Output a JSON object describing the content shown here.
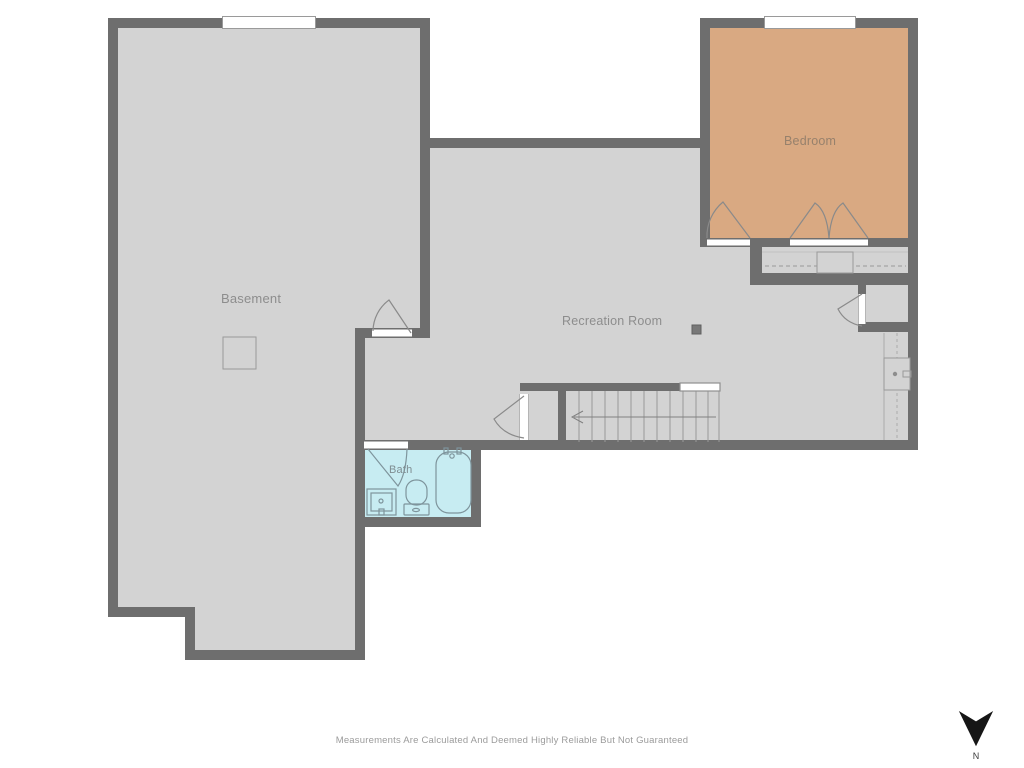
{
  "rooms": {
    "basement": {
      "label": "Basement"
    },
    "recreation": {
      "label": "Recreation Room"
    },
    "bedroom": {
      "label": "Bedroom"
    },
    "bath": {
      "label": "Bath"
    }
  },
  "footer": {
    "disclaimer": "Measurements Are Calculated And Deemed Highly Reliable But Not Guaranteed"
  },
  "compass": {
    "label": "N",
    "direction": "north-points-down"
  },
  "features": {
    "stairs": "staircase-with-down-direction-arrow",
    "closet": "closet-with-hanging-rod-and-shelf",
    "utility": "water-heater-utility-area",
    "bath_fixtures": [
      "sink-vanity",
      "toilet",
      "bathtub"
    ]
  },
  "colors": {
    "wall": "#6e6e6e",
    "floor": "#d3d3d3",
    "bedroom_floor": "#d9a982",
    "bath_floor": "#c7ecf2",
    "door_line": "#8a8a8a",
    "fixture_line": "#7e949c",
    "thin_line": "#9a9a9a",
    "label_text": "#8d8d8d",
    "bedroom_label_text": "#97816c",
    "bath_label_text": "#7f8d92",
    "disclaimer_text": "#9b9b9b",
    "north_arrow": "#161616",
    "background": "#ffffff"
  }
}
